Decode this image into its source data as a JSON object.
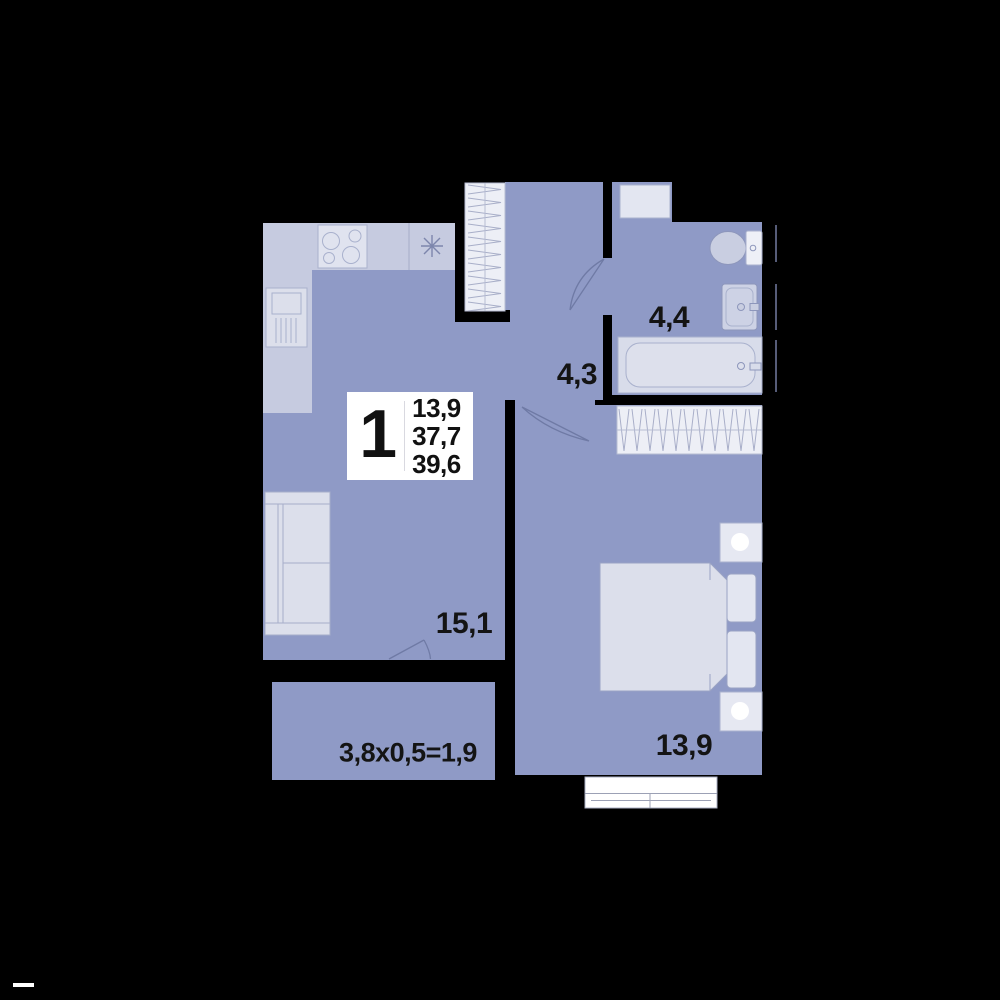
{
  "info_box": {
    "room_count": "1",
    "areas": [
      "13,9",
      "37,7",
      "39,6"
    ]
  },
  "labels": {
    "kitchen_living": "15,1",
    "hallway": "4,3",
    "bathroom": "4,4",
    "bedroom": "13,9",
    "balcony": "3,8x0,5=1,9"
  },
  "fixtures": [
    "stove-icon",
    "kitchen-sink-icon",
    "sink-cabinet-icon",
    "sofa-icon",
    "wardrobe-icon",
    "washing-machine-icon",
    "toilet-icon",
    "washbasin-icon",
    "bathtub-icon",
    "bed-icon",
    "pillow-icon",
    "nightstand-icon",
    "window-icon",
    "door-swing-icon"
  ],
  "colors": {
    "background": "#000000",
    "floor": "#8F9AC6",
    "furniture_mid": "#C6CBE0",
    "furniture_light": "#DCDFEB",
    "wardrobe": "#EDEFF6",
    "outline": "#9AA3C4",
    "label_text": "#141414",
    "info_box_bg": "#FFFFFF"
  }
}
